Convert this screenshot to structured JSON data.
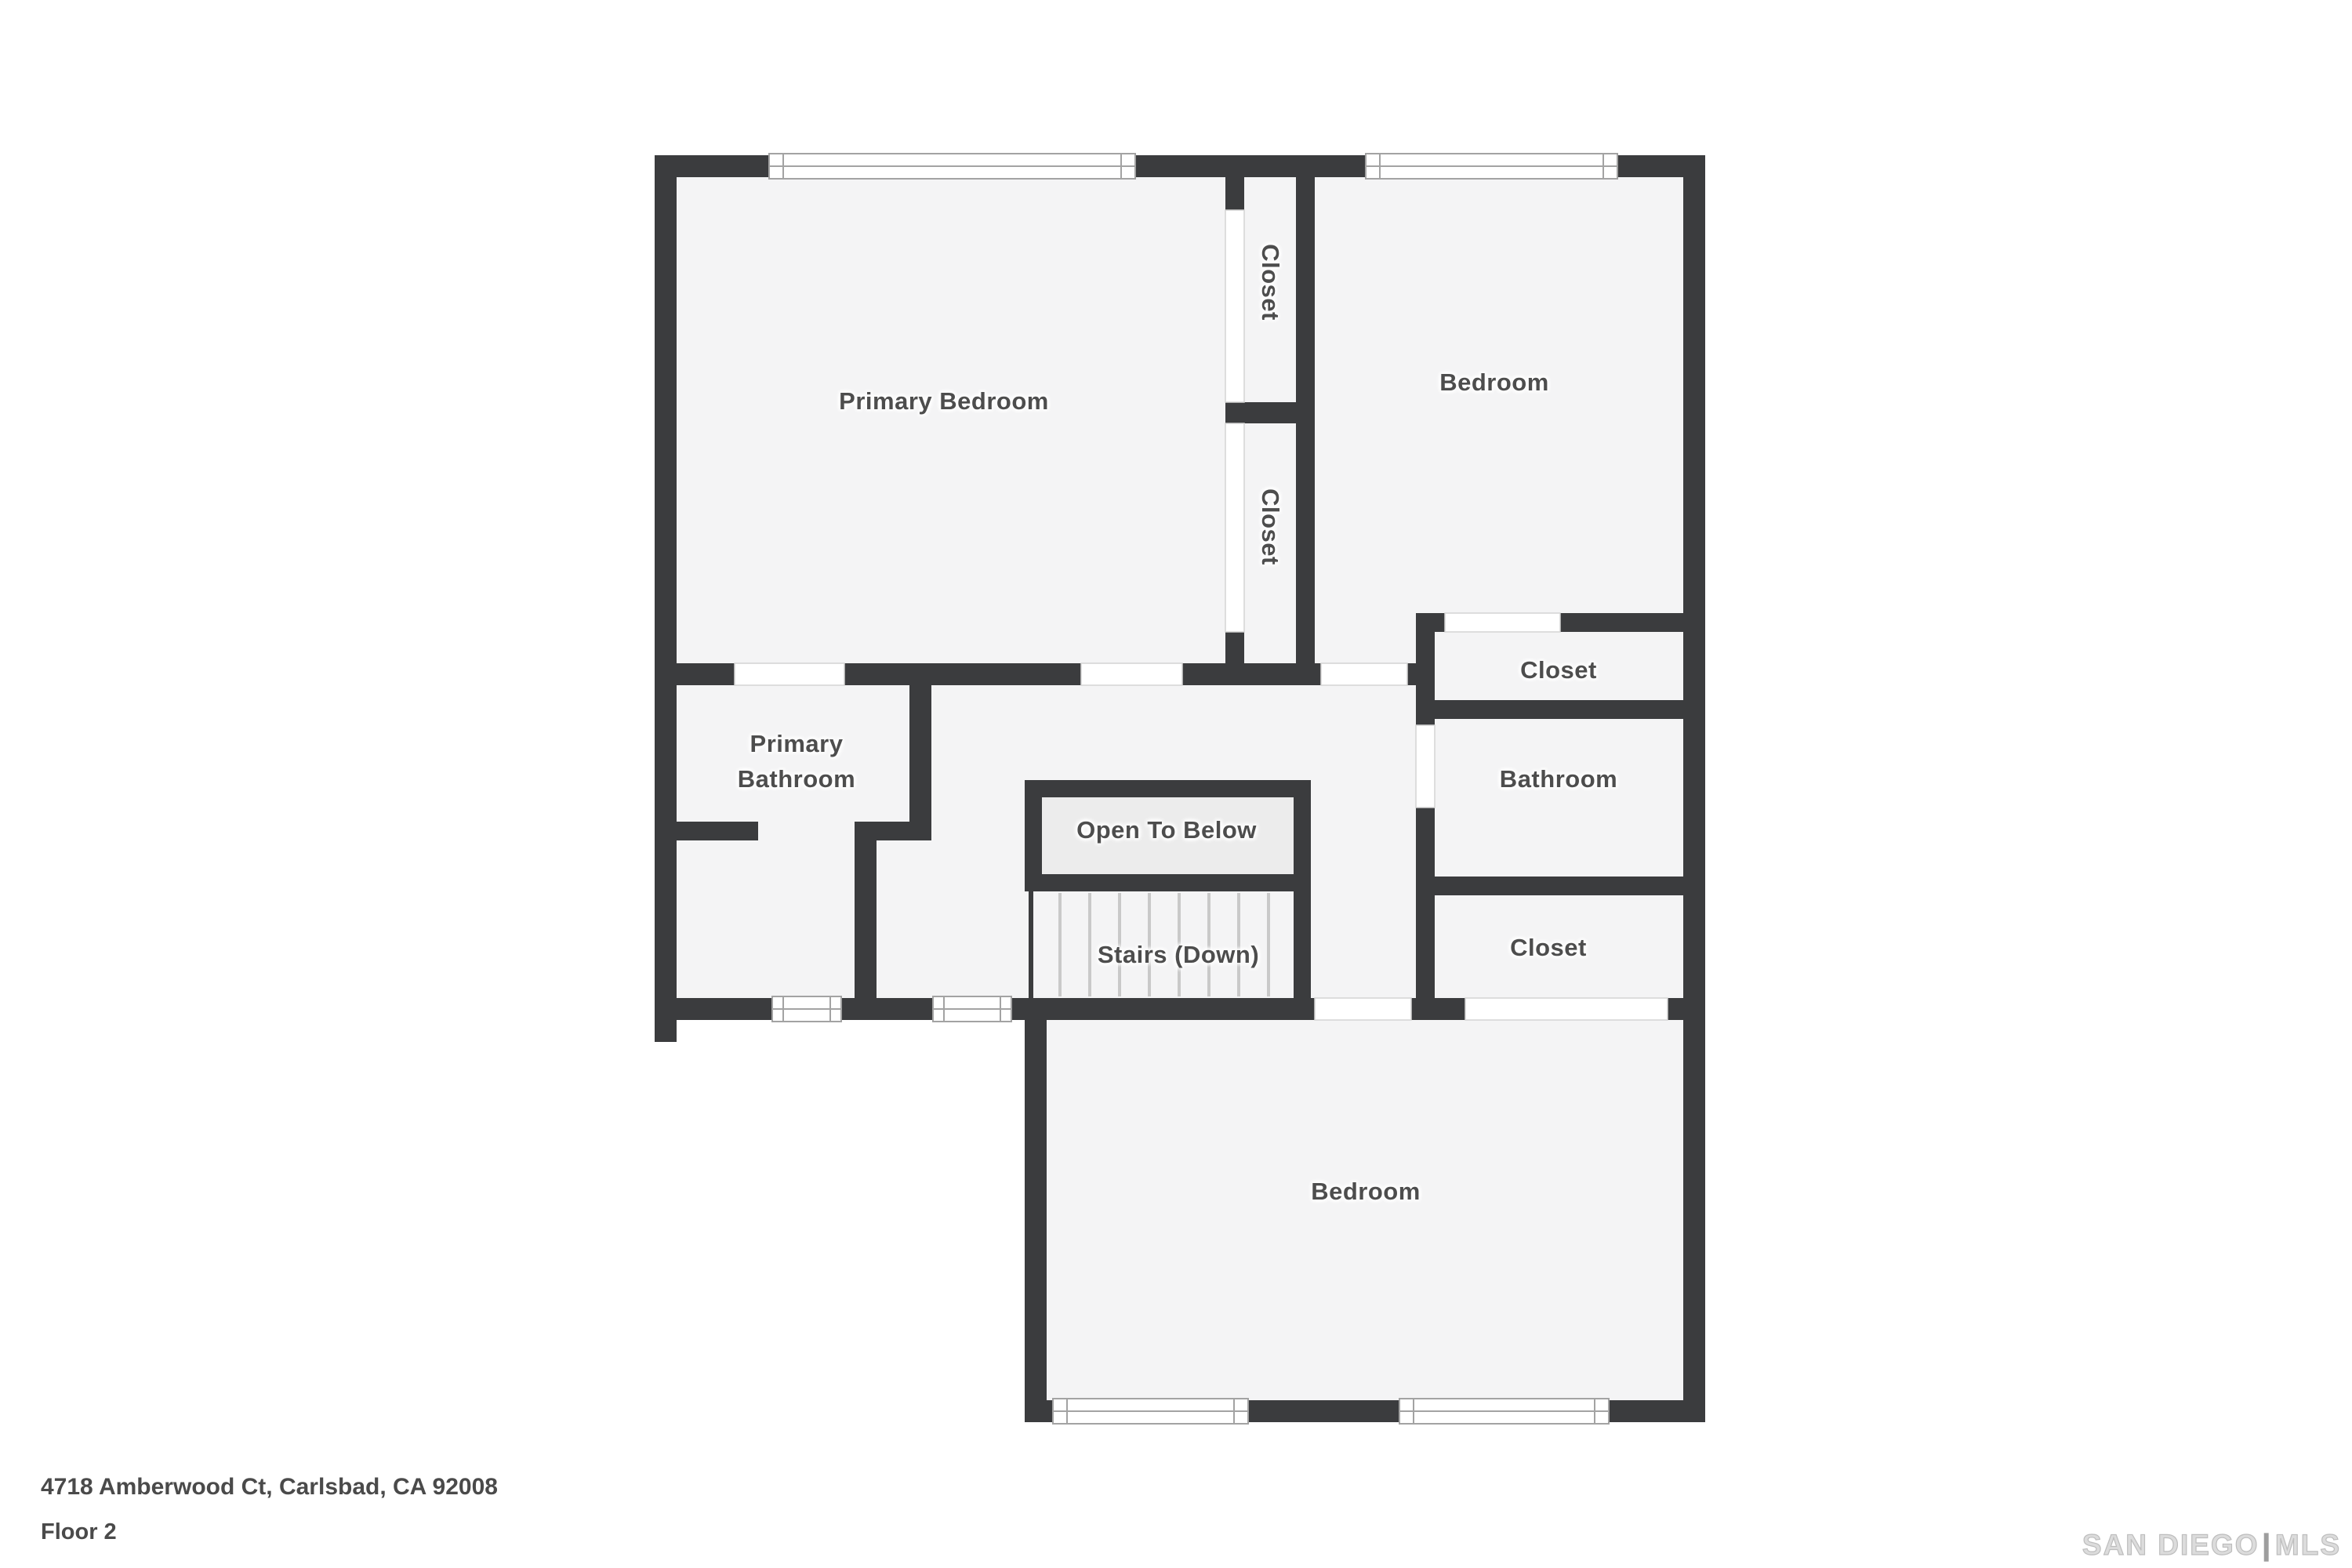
{
  "floorplan": {
    "rooms": {
      "primary_bedroom": "Primary Bedroom",
      "closet_upper": "Closet",
      "closet_lower": "Closet",
      "bedroom_top_right": "Bedroom",
      "closet_right_top": "Closet",
      "bathroom": "Bathroom",
      "closet_right_bottom": "Closet",
      "primary_bathroom": "Primary Bathroom",
      "open_to_below": "Open To Below",
      "stairs": "Stairs (Down)",
      "bedroom_bottom": "Bedroom"
    },
    "colors": {
      "wall": "#3b3c3e",
      "floor": "#f4f4f5",
      "open_area_fill": "#ececec",
      "stair_tread": "#c9c9c9",
      "window_frame": "#a3a3a3",
      "label_text": "#4d4d4d"
    }
  },
  "footer": {
    "address": "4718 Amberwood Ct, Carlsbad, CA 92008",
    "floor": "Floor 2"
  },
  "watermark": {
    "brand": "SAN DIEGO",
    "divider": "|",
    "mls": "MLS"
  }
}
